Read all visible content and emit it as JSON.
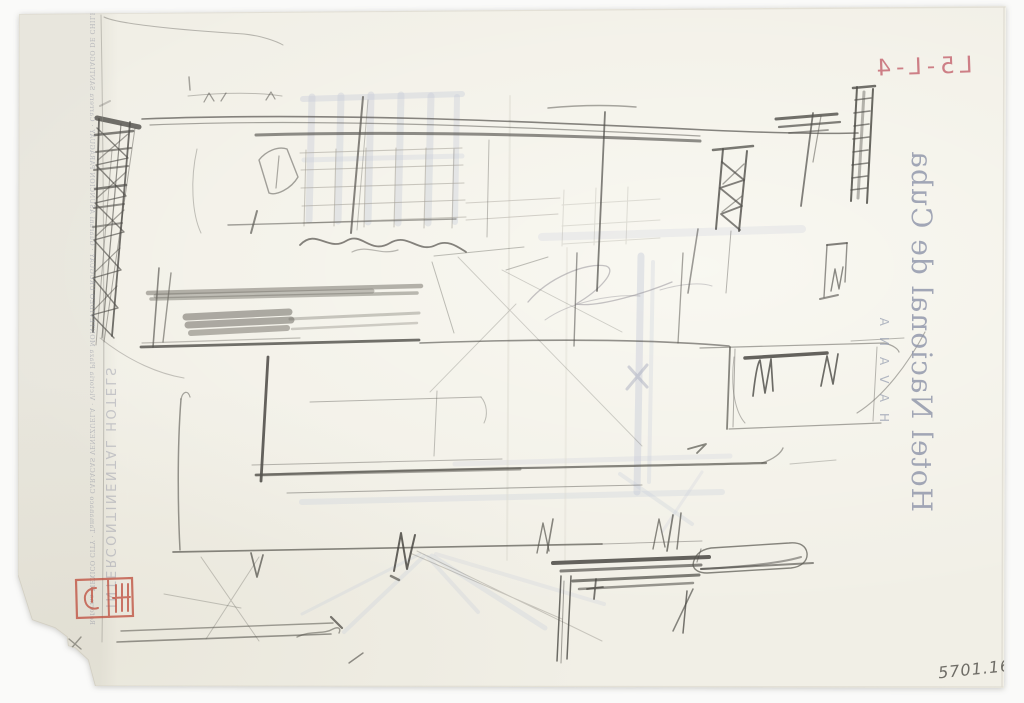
{
  "letterhead": {
    "hotel_name": "Hotel Nacional de Cuba",
    "city": "HAVANA",
    "brand_column": "INTERCONTINENTAL HOTELS",
    "hotels_column": "Reforma MEXICO CITY · Tamanaco CARACAS VENEZUELA · Victoria Plaza MONTEVIDEO URUGUAY · Guarani ASUNCION PARAGUAY · Carrera SANTIAGO DE CHILE · Tequendama BOGOTA COLOMBIA",
    "text_color": "#8d93a8"
  },
  "inscriptions": {
    "red_note": "L5-L-4",
    "red_note_color": "#c4626d",
    "accession_number": "5701.169",
    "pencil_color": "#57554f"
  },
  "stamp": {
    "icon": "red-collection-stamp-icon",
    "color": "#bf5140"
  },
  "palette": {
    "background": "#fafaf9",
    "paper": "#f1efe6",
    "graphite_dark": "#4a4843",
    "graphite_mid": "#6f6c64",
    "graphite_light": "#a09d94",
    "smudge_blue": "#c7ccda"
  }
}
